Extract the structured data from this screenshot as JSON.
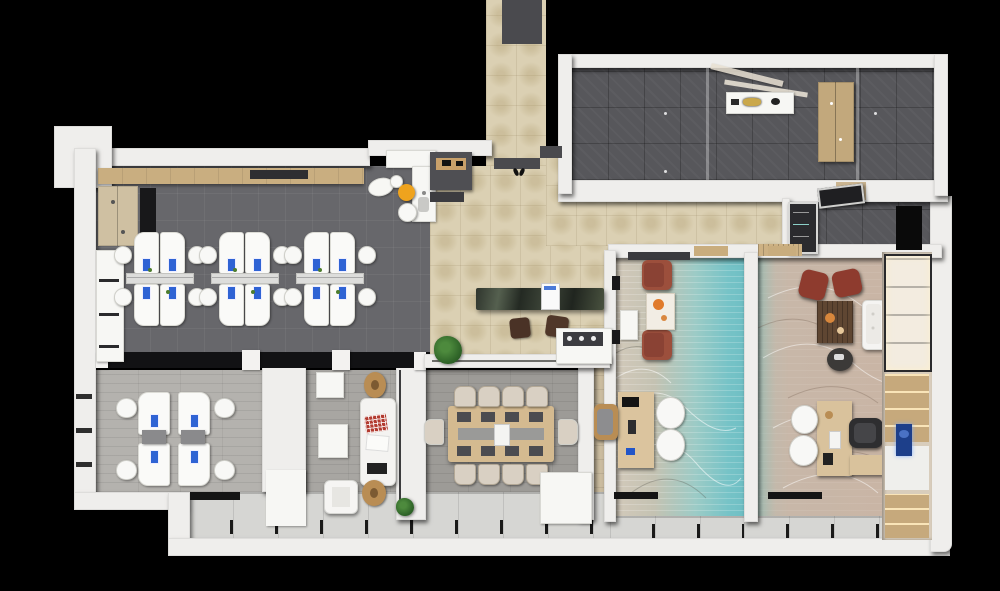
{
  "scene": {
    "kind": "3d-office-floor-plan-top-view",
    "background": "#000000"
  },
  "palette": {
    "wall_white": "#efeeec",
    "carpet_dark_gray": "#67676b",
    "lobby_beige_tile": "#dbd0b3",
    "hall_dark_tile": "#57575b",
    "plank_light": "#b4b2ae",
    "plank_mid": "#a8a6a2",
    "plank_conf": "#9d9b97",
    "window_band": "#d6d6d3",
    "reception_marble": "#343a30",
    "laptop_blue": "#2f63d4",
    "stool_yellow": "#efa31d",
    "armchair_rust": "#9c4f3c",
    "exec_chair_red": "#8e3b2e",
    "wood_light": "#d2b88e",
    "teal_carpet": "#74c2c6",
    "exec_carpet": "#c9b5a5",
    "plant_green": "#2f6428",
    "tv_blue": "#1d3f8a"
  },
  "open_office": {
    "clusters": 3,
    "desks_per_cluster": 4,
    "chairs_per_cluster": 4,
    "features": [
      "wall-shelf",
      "printer",
      "wardrobe",
      "storage-cabinets",
      "kitchenette"
    ]
  },
  "team_office": {
    "clusters": 1,
    "desks_per_cluster": 4,
    "chairs_per_cluster": 4
  },
  "conference_room": {
    "chairs_top": 4,
    "chairs_bottom": 4,
    "chairs_ends": 2,
    "placemats_per_side": 4,
    "table": "wood-with-center-channel"
  },
  "lobby": {
    "furniture": [
      "reception-counter",
      "counter-monitor",
      "visitor-stool",
      "visitor-stool",
      "plant",
      "coffee-cabinet",
      "entry-mats",
      "shoes"
    ]
  },
  "entry_hall": {
    "furniture": [
      "display-shelf",
      "gold-artifacts",
      "ceiling-beams",
      "wardrobe"
    ]
  },
  "cloakroom": {
    "furniture": [
      "coat-closet",
      "leaning-mirror",
      "floor-mat"
    ]
  },
  "manager_office": {
    "carpet": "teal-wave",
    "furniture": [
      "console",
      "armchair",
      "armchair",
      "art-rug",
      "desk",
      "desk-chair",
      "guest-chair",
      "guest-chair"
    ]
  },
  "executive_office": {
    "carpet": "beige-wave",
    "furniture": [
      "book-shelf",
      "red-chair",
      "red-chair",
      "coffee-table",
      "round-side-table",
      "tufted-sofa",
      "desk",
      "desk-return",
      "office-chair",
      "guest-chair",
      "guest-chair",
      "shelving-wall",
      "tv-panel"
    ]
  },
  "lounge": {
    "furniture": [
      "square-table",
      "side-stool",
      "sofa",
      "checkered-pillow",
      "white-pillow",
      "coffee-table",
      "armchair",
      "side-stool"
    ]
  },
  "facade": {
    "window_band": true,
    "white_columns": 2,
    "plants": 1
  }
}
